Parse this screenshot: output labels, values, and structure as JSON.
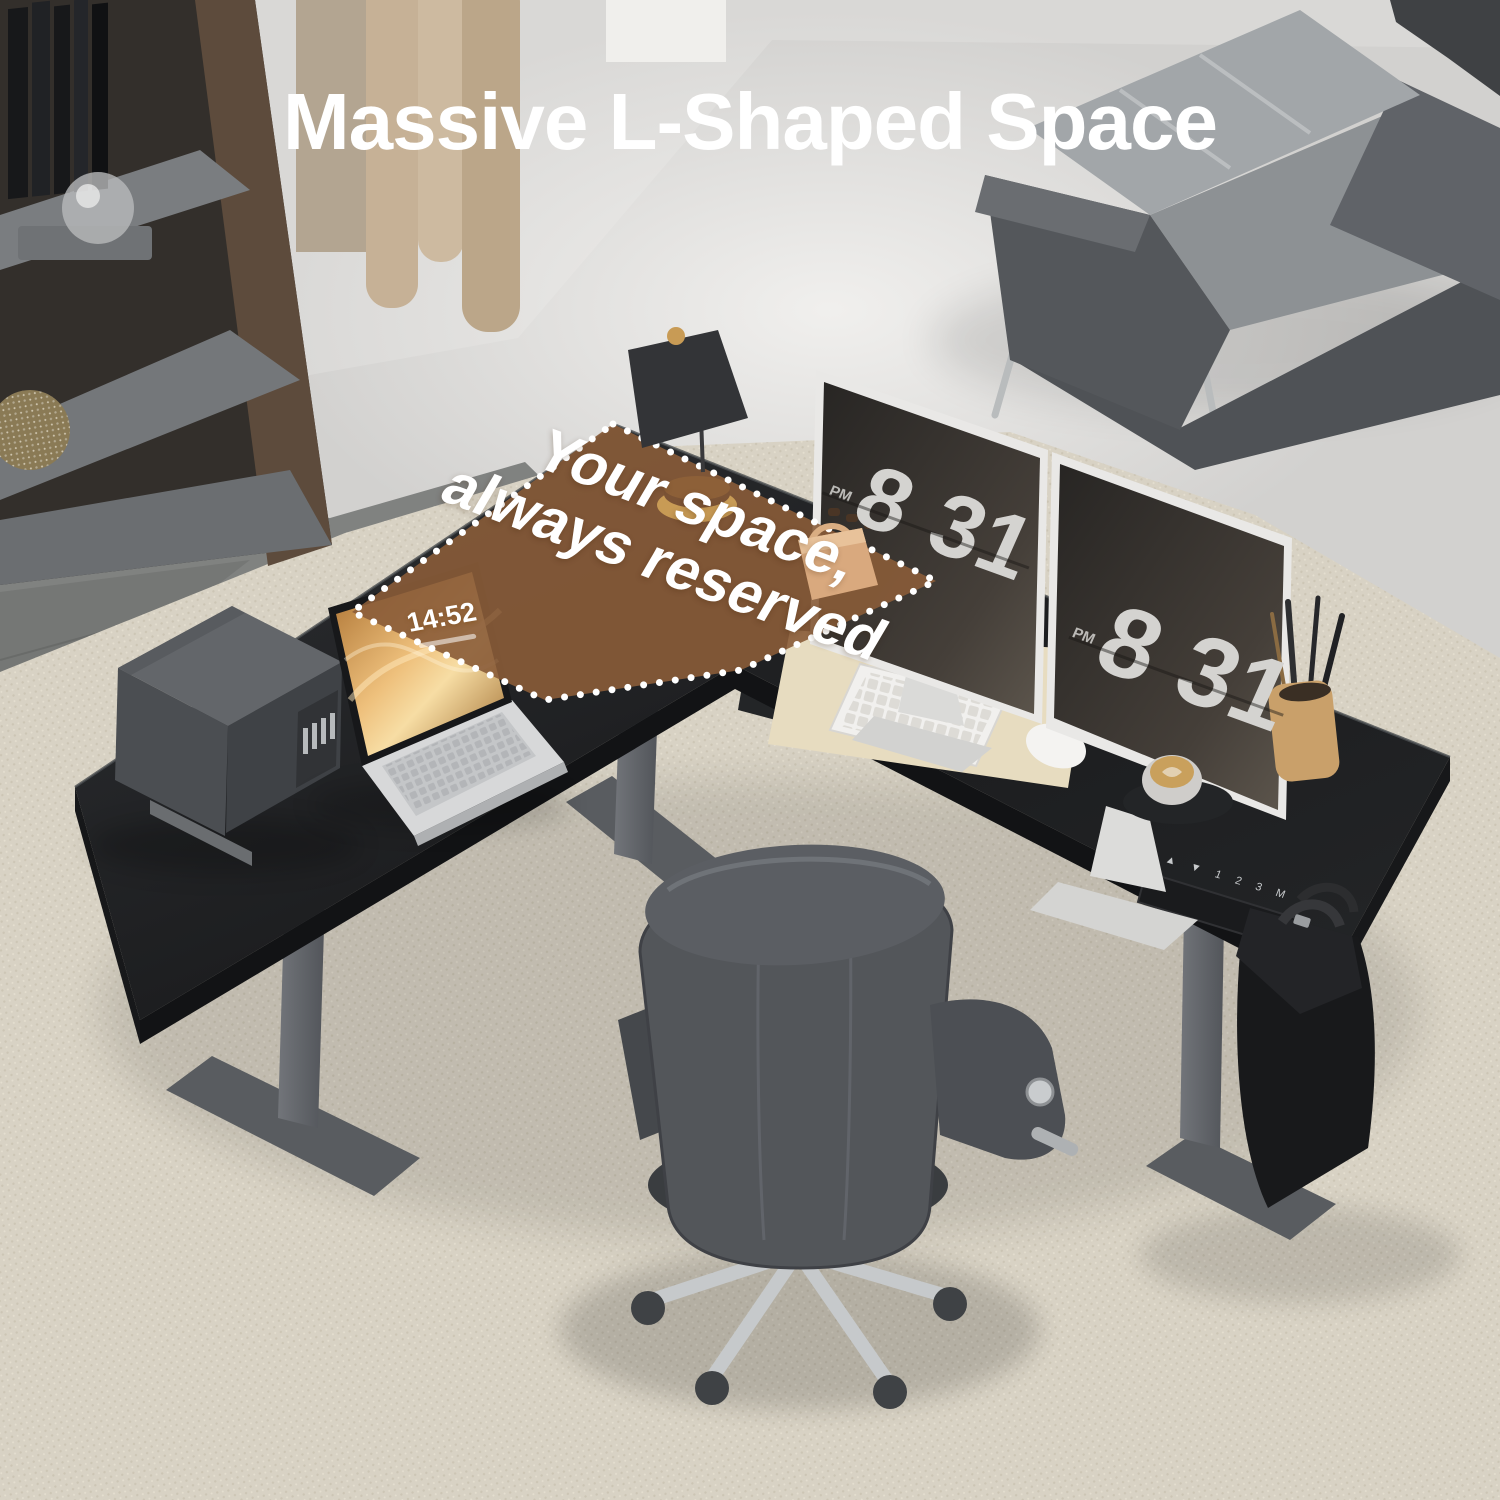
{
  "headline": "Massive L-Shaped Space",
  "overlay": {
    "line1": "Your space,",
    "line2": "always reserved"
  },
  "monitor_clock": {
    "meridiem": "PM",
    "hour": "8",
    "minute": "31"
  },
  "laptop": {
    "time": "14:52"
  },
  "desk_controller": {
    "keys": "▲ ▼ 1 2 3 M"
  },
  "colors": {
    "brown": "#8a5c39",
    "desk": "#202224",
    "leg": "#5f6266",
    "rug": "#d8d2c4",
    "gold": "#c89b55",
    "wood": "#c9a06a",
    "wall": "#d9d8d6",
    "floor": "#d2d1cf",
    "mat": "#e7dcc0",
    "screen": "#34312d",
    "digit": "#d4d3d0",
    "silver": "#e9e8e6",
    "chair": "#53565a"
  }
}
